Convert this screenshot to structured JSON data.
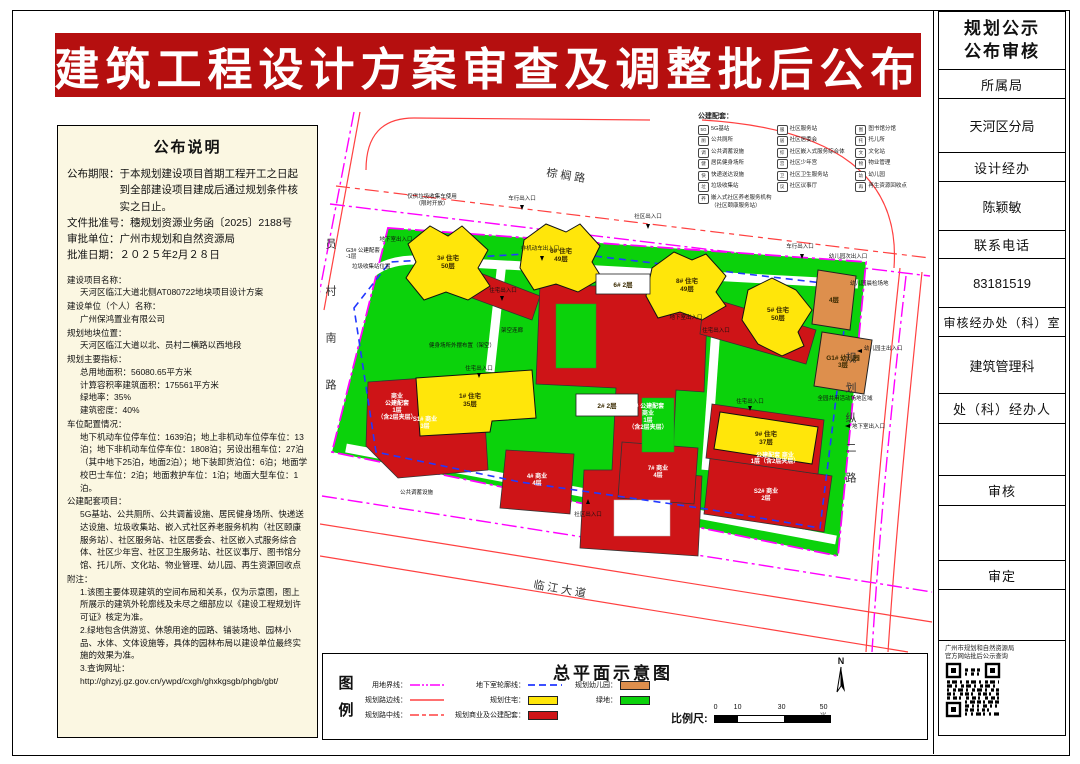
{
  "banner": {
    "title": "建筑工程设计方案审查及调整批后公布"
  },
  "colors": {
    "banner_red": "#b50f0f",
    "panel_cream": "#fbf7e2",
    "residential_yellow": "#ffe60a",
    "commercial_red": "#ce1417",
    "kindergarten_orange": "#dd8f4d",
    "green_space": "#0bd20b",
    "boundary_magenta": "#ff00ff",
    "underground_blue": "#2238ff",
    "road_red": "#ff4040"
  },
  "left_panel": {
    "heading": "公布说明",
    "notice": [
      {
        "label": "公布期限：",
        "text": "于本规划建设项目首期工程开工之日起到全部建设项目建成后通过规划条件核实之日止。"
      },
      {
        "label": "文件批准号：",
        "text": "穗规划资源业务函〔2025〕2188号"
      },
      {
        "label": "审批单位：",
        "text": "广州市规划和自然资源局"
      },
      {
        "label": "批准日期：",
        "text": "２０２５年2月２８日"
      }
    ],
    "details": [
      {
        "label": "建设项目名称：",
        "lines": [
          "天河区临江大道北侧AT080722地块项目设计方案"
        ]
      },
      {
        "label": "建设单位（个人）名称：",
        "lines": [
          "广州保鸿置业有限公司"
        ]
      },
      {
        "label": "规划地块位置：",
        "lines": [
          "天河区临江大道以北、员村二横路以西地段"
        ]
      },
      {
        "label": "规划主要指标：",
        "lines": [
          "总用地面积：56080.65平方米",
          "计算容积率建筑面积：175561平方米",
          "绿地率：35%",
          "建筑密度：40%"
        ]
      },
      {
        "label": "车位配置情况：",
        "lines": [
          "地下机动车位停车位：1639泊；地上非机动车位停车位：13泊；地下非机动车位停车位：1808泊；另设出租车位：27泊（其中地下25泊，地面2泊）；地下装卸货泊位：6泊；地面学校巴士车位：2泊；地面救护车位：1泊；地面大型车位：1泊。"
        ]
      },
      {
        "label": "公建配套项目：",
        "lines": [
          "5G基站、公共厕所、公共调蓄设施、居民健身场所、快递送达设施、垃圾收集站、嵌入式社区养老服务机构（社区颐康服务站）、社区服务站、社区居委会、社区嵌入式服务综合体、社区少年宫、社区卫生服务站、社区议事厅、图书馆分馆、托儿所、文化站、物业管理、幼儿园、再生资源回收点"
        ]
      },
      {
        "label": "附注：",
        "lines": [
          "1.该图主要体现建筑的空间布局和关系，仅为示意图，图上所展示的建筑外轮廓线及未尽之细部应以《建设工程规划许可证》核定为准。",
          "2.绿地包含供游览、休憩用途的园路、铺装场地、园林小品、水体、文体设施等，具体的园林布局以建设单位最终实施的效果为准。",
          "3.查询网址：",
          "http://ghzyj.gz.gov.cn/ywpd/cxgh/ghxkgsgb/phgb/gbt/"
        ]
      }
    ]
  },
  "facilities": {
    "title": "公建配套：",
    "col1": [
      {
        "abbr": "5G",
        "label": "5G基站"
      },
      {
        "abbr": "厕",
        "label": "公共厕所"
      },
      {
        "abbr": "调",
        "label": "公共调蓄设施"
      },
      {
        "abbr": "健",
        "label": "居民健身场所"
      },
      {
        "abbr": "快",
        "label": "快递送达设施"
      },
      {
        "abbr": "垃",
        "label": "垃圾收集站"
      },
      {
        "abbr": "养",
        "label": "嵌入式社区养老服务机构（社区颐康服务站）"
      }
    ],
    "col2": [
      {
        "abbr": "服",
        "label": "社区服务站"
      },
      {
        "abbr": "居",
        "label": "社区居委会"
      },
      {
        "abbr": "综",
        "label": "社区嵌入式服务综合体"
      },
      {
        "abbr": "宫",
        "label": "社区少年宫"
      },
      {
        "abbr": "卫",
        "label": "社区卫生服务站"
      },
      {
        "abbr": "议",
        "label": "社区议事厅"
      }
    ],
    "col3": [
      {
        "abbr": "图",
        "label": "图书馆分馆"
      },
      {
        "abbr": "托",
        "label": "托儿所"
      },
      {
        "abbr": "文",
        "label": "文化站"
      },
      {
        "abbr": "物",
        "label": "物业管理"
      },
      {
        "abbr": "幼",
        "label": "幼儿园"
      },
      {
        "abbr": "再",
        "label": "再生资源回收点"
      }
    ]
  },
  "map": {
    "roads": {
      "top": "棕榈路",
      "left": "员村南路",
      "right": "规划纵二路",
      "bottom": "临江大道"
    },
    "buildings": {
      "b3": {
        "name": "3# 住宅",
        "floors": "50层"
      },
      "b6": {
        "name": "6# 住宅",
        "floors": "49层"
      },
      "b8": {
        "name": "8# 住宅",
        "floors": "49层"
      },
      "b5": {
        "name": "5# 住宅",
        "floors": "50层"
      },
      "b1": {
        "name": "1# 住宅",
        "floors": "35层"
      },
      "b9": {
        "name": "9# 住宅",
        "floors": "37层"
      },
      "s1": {
        "name": "S1# 商业",
        "floors": "3层"
      },
      "s2": {
        "name": "S2# 商业",
        "floors": "2层"
      },
      "c4": {
        "name": "4# 商业",
        "floors": "4层"
      },
      "c7": {
        "name": "7# 商业",
        "floors": "4层"
      },
      "c2": {
        "l1": "2# 公建配套",
        "l2": "商业",
        "l3": "1层",
        "l4": "（含2层夹层）"
      },
      "biz_sw": {
        "l1": "商业",
        "l2": "公建配套",
        "l3": "1层",
        "l4": "（含2层夹层）"
      },
      "biz_se": {
        "l1": "公建配套 商业",
        "l2": "1层（含2层夹层）"
      },
      "w6": {
        "name": "6#  2层"
      },
      "w2": {
        "name": "2#  2层"
      },
      "g1": {
        "name": "G1# 幼儿园",
        "floors": "3层"
      },
      "g1a": {
        "name": "4层"
      },
      "g3": {
        "l1": "G3# 公建配套",
        "l2": "-1层"
      }
    },
    "labels": {
      "garbage_note1": "仅供垃圾收集车使用",
      "garbage_note2": "（限时开放）",
      "garbage_station": "垃圾收集站位置",
      "storm_facility": "公共调蓄设施",
      "corridor": "架空连廊",
      "fitness": "健身场所外摆布置（架空）",
      "kg_check": "幼儿园晨检场地",
      "kg_shared": "全园共用活动场地区域"
    },
    "entrances": [
      "车行出入口",
      "社区出入口",
      "车行出入口",
      "幼儿园次出入口",
      "非机动车出入口",
      "地下室出入口",
      "住宅出入口",
      "住宅出入口",
      "地下室出入口",
      "幼儿园主出入口",
      "住宅出入口",
      "住宅出入口",
      "地下室出入口",
      "社区出入口"
    ]
  },
  "legend": {
    "box_label_1": "图",
    "box_label_2": "例",
    "map_title": "总平面示意图",
    "items": [
      {
        "label": "用地界线："
      },
      {
        "label": "规划路边线："
      },
      {
        "label": "规划路中线："
      },
      {
        "label": "地下室轮廓线："
      },
      {
        "label": "规划住宅："
      },
      {
        "label": "规划商业及公建配套："
      },
      {
        "label": "规划幼儿园："
      },
      {
        "label": "绿地："
      }
    ],
    "scale_label": "比例尺:",
    "scale_ticks": [
      "0",
      "10",
      "30",
      "50米"
    ],
    "compass_n": "N"
  },
  "sidebar": {
    "title_line1": "规划公示",
    "title_line2": "公布审核",
    "rows": [
      {
        "label": "所属局",
        "value": "天河区分局"
      },
      {
        "label": "设计经办",
        "value": "陈颖敏"
      },
      {
        "label": "联系电话",
        "value": "83181519"
      },
      {
        "label": "审核经办处（科）室",
        "value": "建筑管理科"
      },
      {
        "label": "处（科）经办人",
        "value": ""
      },
      {
        "label": "审核",
        "value": ""
      },
      {
        "label": "审定",
        "value": ""
      }
    ],
    "qr_caption_line1": "广州市规划和自然资源局",
    "qr_caption_line2": "官方网站批后公示查询"
  }
}
